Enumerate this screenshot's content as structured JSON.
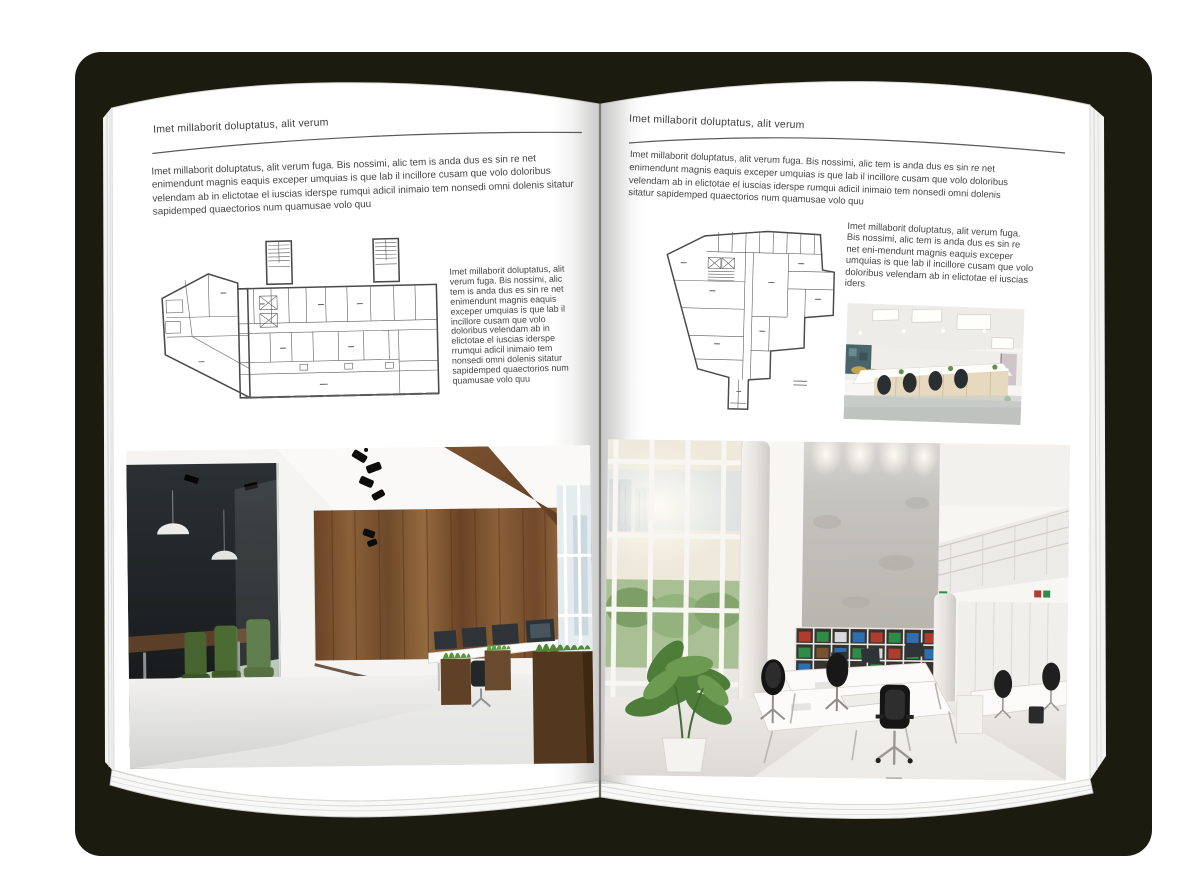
{
  "artwork": {
    "kind": "open-magazine-mockup",
    "background_color": "#ffffff",
    "backdrop_shadow_color": "#1b1b0f",
    "page_color": "#ffffff"
  },
  "left_page": {
    "header": "Imet millaborit doluptatus, alit verum",
    "intro_paragraph": "Imet millaborit doluptatus, alit verum fuga. Bis nossimi, alic tem is anda dus es sin re net enimendunt magnis eaquis exceper umquias is que lab il incillore cusam que volo doloribus velendam ab in elictotae el iuscias iderspe rumqui adicil inimaio tem nonsedi omni dolenis sitatur sapidemped quaectorios num quamusae volo quu",
    "plan_caption": "Imet millaborit doluptatus, alit verum fuga. Bis nossimi, alic tem is anda dus es sin re net enimendunt magnis eaquis exceper umquias is que lab il incillore cusam que volo doloribus velendam ab in elictotae el iuscias iderspe rrumqui adicil inimaio tem nonsedi omni dolenis sitatur sapidemped quaectorios num quamusae volo quu",
    "floor_plan": "wide building floor plan with two hatched stair towers and angled left annex",
    "photo": "office interior with dark glass meeting room, green chairs, wood plank wall and beam, white desks with monitors, wooden grass planters"
  },
  "right_page": {
    "header": "Imet millaborit doluptatus, alit verum",
    "intro_paragraph": "Imet millaborit doluptatus, alit verum fuga. Bis nossimi, alic tem is anda dus es sin re net enimendunt magnis eaquis exceper umquias is que lab il incillore cusam que volo doloribus velendam ab in elictotae el iuscias iderspe rumqui adicil inimaio tem nonsedi omni dolenis sitatur sapidemped quaectorios num quamusae volo quu",
    "plan_caption": "Imet millaborit doluptatus, alit verum fuga. Bis nossimi, alic tem is anda dus es sin re net eni-mendunt magnis eaquis exceper umquias is que lab il incillore cusam que volo doloribus velendam ab in elictotae el iuscias iders",
    "floor_plan": "irregular tower floor plan with elevator core and bottom corridor stem",
    "photo_small": "white open office with rows of desks, pale wood cabinets, black chairs and ceiling light panels",
    "photo_large": "double-height white office with glazed wall, concrete feature wall, binder bookshelf, mezzanine, white desks and black mesh chairs"
  },
  "palette": {
    "backdrop": "#1b1b0f",
    "text": "#454545",
    "plan_line": "#4a4a4a",
    "wood": "#7a5431",
    "chair_green": "#4c6b33",
    "binder_red": "#b23a2e",
    "binder_green": "#2e8b49",
    "binder_blue": "#2e6fb2",
    "floor_gray": "#d5d6d4"
  }
}
